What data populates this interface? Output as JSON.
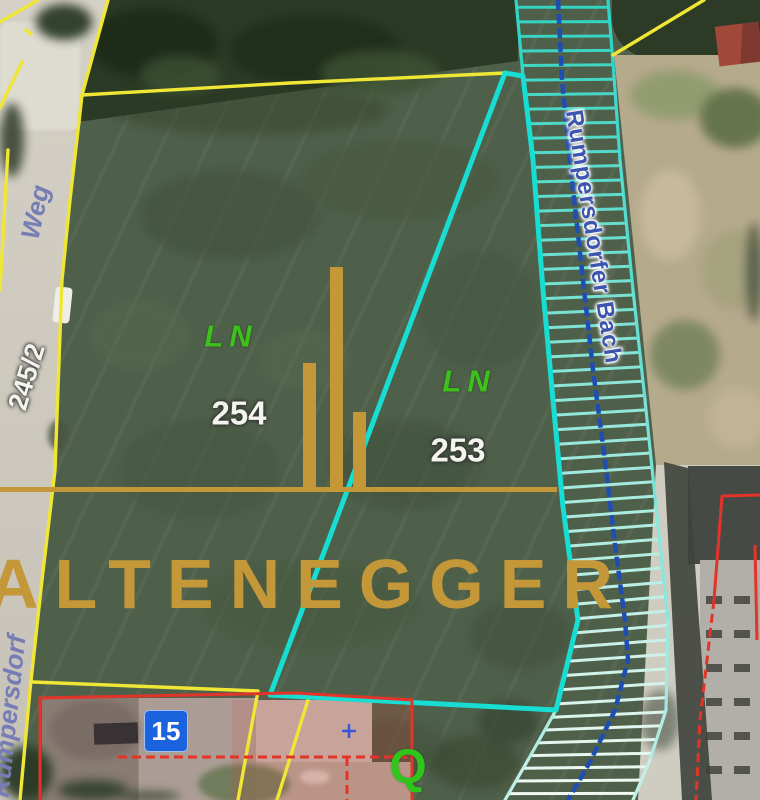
{
  "map": {
    "watermark": {
      "text": "ALTENEGGER"
    },
    "parcels": [
      {
        "use": "LN",
        "number": "254"
      },
      {
        "use": "LN",
        "number": "253"
      }
    ],
    "labels": {
      "street": "Weg",
      "parcel_left": "245/2",
      "village": "Rumpersdorf",
      "stream": "Rumpersdorfer Bach",
      "house_number": "15",
      "vegetation_symbol": "Q"
    },
    "colors": {
      "cadastre_yellow": "#f0e636",
      "parcel_cyan": "#17ddd3",
      "band_edge": "#28d3c6",
      "rung_top": "#30d3c0",
      "rung_bottom": "#f2f9f3",
      "stream_blue": "#1e4db4",
      "red_outline": "#e23428",
      "gold": "#c49738",
      "survey_cross_blue": "#3c55d8"
    },
    "geometry": {
      "yellow_lines": [
        [
          [
            108,
            0
          ],
          [
            82,
            95
          ],
          [
            70,
            200
          ],
          [
            62,
            280
          ],
          [
            55,
            470
          ],
          [
            42,
            580
          ],
          [
            30,
            690
          ],
          [
            20,
            800
          ]
        ],
        [
          [
            82,
            95
          ],
          [
            290,
            83
          ],
          [
            505,
            73
          ]
        ],
        [
          [
            704,
            0
          ],
          [
            613,
            55
          ]
        ],
        [
          [
            33,
            682
          ],
          [
            258,
            691
          ],
          [
            238,
            800
          ]
        ],
        [
          [
            308,
            700
          ],
          [
            277,
            800
          ]
        ],
        [
          [
            8,
            150
          ],
          [
            0,
            290
          ]
        ],
        [
          [
            0,
            22
          ],
          [
            38,
            0
          ]
        ],
        [
          [
            0,
            108
          ],
          [
            22,
            62
          ]
        ],
        [
          [
            26,
            30
          ],
          [
            31,
            34
          ]
        ]
      ],
      "parcel_boundary": [
        [
          505,
          73
        ],
        [
          270,
          695
        ],
        [
          556,
          710
        ],
        [
          578,
          620
        ],
        [
          563,
          507
        ],
        [
          553,
          400
        ],
        [
          543,
          290
        ],
        [
          533,
          160
        ],
        [
          523,
          76
        ],
        [
          505,
          73
        ]
      ],
      "band": {
        "left": [
          [
            516,
            0
          ],
          [
            523,
            76
          ],
          [
            533,
            160
          ],
          [
            543,
            290
          ],
          [
            553,
            400
          ],
          [
            563,
            507
          ],
          [
            578,
            620
          ],
          [
            556,
            710
          ],
          [
            528,
            760
          ],
          [
            505,
            800
          ]
        ],
        "right": [
          [
            608,
            0
          ],
          [
            614,
            76
          ],
          [
            620,
            160
          ],
          [
            633,
            290
          ],
          [
            645,
            400
          ],
          [
            656,
            507
          ],
          [
            668,
            620
          ],
          [
            666,
            710
          ],
          [
            650,
            760
          ],
          [
            633,
            800
          ]
        ],
        "rung_count": 56
      },
      "stream": [
        [
          558,
          0
        ],
        [
          562,
          80
        ],
        [
          572,
          180
        ],
        [
          583,
          280
        ],
        [
          593,
          370
        ],
        [
          605,
          460
        ],
        [
          615,
          545
        ],
        [
          625,
          620
        ],
        [
          628,
          660
        ],
        [
          615,
          710
        ],
        [
          590,
          762
        ],
        [
          568,
          800
        ]
      ],
      "red_solid": [
        [
          [
            40,
            800
          ],
          [
            40,
            698
          ],
          [
            295,
            693
          ],
          [
            412,
            700
          ],
          [
            412,
            800
          ]
        ],
        [
          [
            760,
            495
          ],
          [
            722,
            496
          ],
          [
            714,
            600
          ]
        ],
        [
          [
            755,
            545
          ],
          [
            757,
            640
          ]
        ]
      ],
      "red_dashed": [
        [
          [
            118,
            757
          ],
          [
            412,
            757
          ]
        ],
        [
          [
            347,
            757
          ],
          [
            347,
            800
          ]
        ],
        [
          [
            714,
            600
          ],
          [
            700,
            720
          ],
          [
            696,
            800
          ]
        ]
      ],
      "survey_cross": [
        349,
        731
      ]
    }
  }
}
